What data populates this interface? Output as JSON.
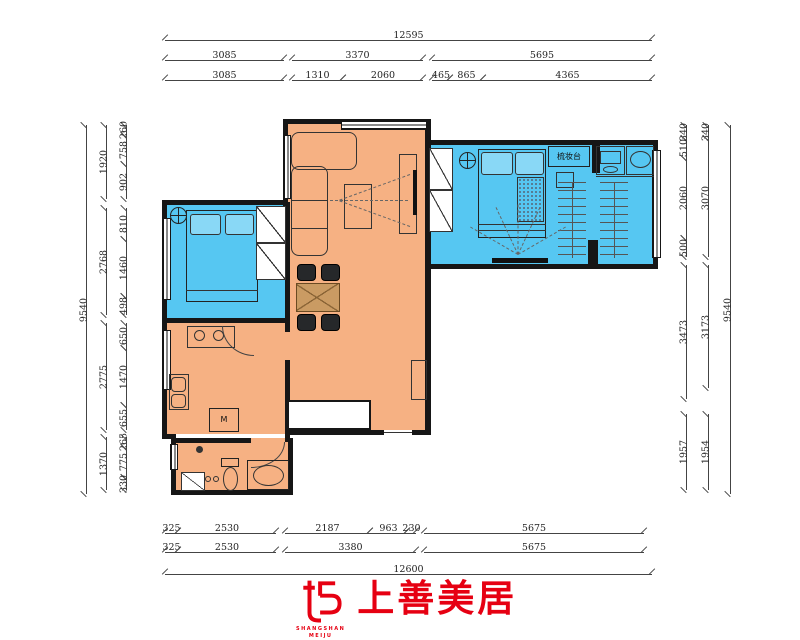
{
  "colors": {
    "orange": "#F6B183",
    "blue": "#56C7F2",
    "wall": "#161616",
    "dim": "#444",
    "red": "#E60012"
  },
  "logo": {
    "cn": "上善美居",
    "en1": "SHANGSHAN",
    "en2": "MEIJU"
  },
  "dims": {
    "h": [
      [
        "12595",
        165,
        40,
        487
      ],
      [
        "3085",
        165,
        60,
        119
      ],
      [
        "3370",
        292,
        60,
        131
      ],
      [
        "5695",
        432,
        60,
        220
      ],
      [
        "3085",
        165,
        80,
        119
      ],
      [
        "1310",
        292,
        80,
        51
      ],
      [
        "2060",
        343,
        80,
        80
      ],
      [
        "465",
        432,
        80,
        18
      ],
      [
        "865",
        450,
        80,
        33
      ],
      [
        "4365",
        483,
        80,
        169
      ],
      [
        "325",
        165,
        533,
        13
      ],
      [
        "2530",
        178,
        533,
        98
      ],
      [
        "2187",
        285,
        533,
        85
      ],
      [
        "963",
        370,
        533,
        37
      ],
      [
        "230",
        407,
        533,
        9
      ],
      [
        "5675",
        424,
        533,
        220
      ],
      [
        "325",
        165,
        552,
        13
      ],
      [
        "2530",
        178,
        552,
        98
      ],
      [
        "3380",
        285,
        552,
        131
      ],
      [
        "5675",
        424,
        552,
        220
      ],
      [
        "12600",
        165,
        574,
        487
      ]
    ],
    "v": [
      [
        "9540",
        86,
        125,
        369
      ],
      [
        "1920",
        106,
        125,
        74
      ],
      [
        "2768",
        106,
        208,
        107
      ],
      [
        "2775",
        106,
        323,
        107
      ],
      [
        "1370",
        106,
        437,
        53
      ],
      [
        "260",
        126,
        125,
        10
      ],
      [
        "758",
        126,
        135,
        29
      ],
      [
        "902",
        126,
        164,
        35
      ],
      [
        "810",
        126,
        208,
        31
      ],
      [
        "1460",
        126,
        239,
        57
      ],
      [
        "498",
        126,
        296,
        19
      ],
      [
        "650",
        126,
        323,
        25
      ],
      [
        "1470",
        126,
        348,
        57
      ],
      [
        "655",
        126,
        405,
        25
      ],
      [
        "265",
        126,
        437,
        10
      ],
      [
        "775",
        126,
        447,
        30
      ],
      [
        "330",
        126,
        477,
        13
      ],
      [
        "340",
        686,
        125,
        13
      ],
      [
        "510",
        686,
        138,
        20
      ],
      [
        "2060",
        686,
        158,
        80
      ],
      [
        "500",
        686,
        238,
        19
      ],
      [
        "3473",
        686,
        265,
        134
      ],
      [
        "1957",
        686,
        414,
        76
      ],
      [
        "340",
        708,
        125,
        13
      ],
      [
        "3070",
        708,
        138,
        119
      ],
      [
        "3173",
        708,
        265,
        123
      ],
      [
        "1954",
        708,
        414,
        76
      ],
      [
        "9540",
        730,
        125,
        369
      ]
    ]
  },
  "plan": {
    "items": [
      {
        "c": "room-orange",
        "n": "living-dining-area",
        "x": 287,
        "y": 123,
        "w": 140,
        "h": 307
      },
      {
        "c": "room-orange",
        "n": "kitchen-area",
        "x": 167,
        "y": 322,
        "w": 120,
        "h": 112
      },
      {
        "c": "room-orange",
        "n": "bathroom-area",
        "x": 175,
        "y": 438,
        "w": 116,
        "h": 54
      },
      {
        "c": "room-blue",
        "n": "bedroom-left-area",
        "x": 167,
        "y": 204,
        "w": 120,
        "h": 114
      },
      {
        "c": "room-blue",
        "n": "bedroom-right-area",
        "x": 427,
        "y": 144,
        "w": 228,
        "h": 120
      },
      {
        "c": "wall",
        "n": "wall",
        "x": 283,
        "y": 119,
        "w": 148,
        "h": 5
      },
      {
        "c": "wall",
        "n": "wall",
        "x": 283,
        "y": 119,
        "w": 5,
        "h": 88
      },
      {
        "c": "wall",
        "n": "wall",
        "x": 162,
        "y": 200,
        "w": 126,
        "h": 5
      },
      {
        "c": "wall",
        "n": "wall",
        "x": 162,
        "y": 200,
        "w": 5,
        "h": 122
      },
      {
        "c": "wall",
        "n": "wall",
        "x": 162,
        "y": 318,
        "w": 126,
        "h": 5
      },
      {
        "c": "wall",
        "n": "wall",
        "x": 162,
        "y": 318,
        "w": 5,
        "h": 120
      },
      {
        "c": "wall",
        "n": "wall",
        "x": 162,
        "y": 434,
        "w": 14,
        "h": 5
      },
      {
        "c": "wall",
        "n": "wall",
        "x": 171,
        "y": 438,
        "w": 5,
        "h": 57
      },
      {
        "c": "wall",
        "n": "wall",
        "x": 173,
        "y": 490,
        "w": 120,
        "h": 5
      },
      {
        "c": "wall",
        "n": "wall",
        "x": 288,
        "y": 438,
        "w": 5,
        "h": 57
      },
      {
        "c": "wall",
        "n": "wall",
        "x": 173,
        "y": 438,
        "w": 78,
        "h": 5
      },
      {
        "c": "wall",
        "n": "wall",
        "x": 285,
        "y": 202,
        "w": 5,
        "h": 130
      },
      {
        "c": "wall",
        "n": "wall",
        "x": 285,
        "y": 360,
        "w": 5,
        "h": 82
      },
      {
        "c": "wall",
        "n": "wall",
        "x": 285,
        "y": 430,
        "w": 99,
        "h": 5
      },
      {
        "c": "wall",
        "n": "wall",
        "x": 412,
        "y": 430,
        "w": 19,
        "h": 5
      },
      {
        "c": "wall",
        "n": "wall",
        "x": 425,
        "y": 119,
        "w": 6,
        "h": 28
      },
      {
        "c": "wall",
        "n": "wall",
        "x": 425,
        "y": 144,
        "w": 6,
        "h": 124
      },
      {
        "c": "wall",
        "n": "wall",
        "x": 425,
        "y": 266,
        "w": 6,
        "h": 169
      },
      {
        "c": "wall",
        "n": "wall",
        "x": 425,
        "y": 140,
        "w": 233,
        "h": 5
      },
      {
        "c": "wall",
        "n": "wall",
        "x": 653,
        "y": 140,
        "w": 5,
        "h": 129
      },
      {
        "c": "wall",
        "n": "wall",
        "x": 425,
        "y": 264,
        "w": 233,
        "h": 5
      },
      {
        "c": "wall",
        "n": "closet-partition",
        "x": 592,
        "y": 140,
        "w": 8,
        "h": 33
      },
      {
        "c": "wall",
        "n": "closet-partition",
        "x": 588,
        "y": 240,
        "w": 10,
        "h": 28
      },
      {
        "c": "winh",
        "n": "window",
        "x": 341,
        "y": 120,
        "w": 86,
        "h": 10
      },
      {
        "c": "winv",
        "n": "window",
        "x": 283,
        "y": 135,
        "w": 8,
        "h": 64
      },
      {
        "c": "winv",
        "n": "window",
        "x": 162,
        "y": 218,
        "w": 9,
        "h": 82
      },
      {
        "c": "winv",
        "n": "window",
        "x": 162,
        "y": 330,
        "w": 9,
        "h": 60
      },
      {
        "c": "winv",
        "n": "window",
        "x": 170,
        "y": 444,
        "w": 8,
        "h": 26
      },
      {
        "c": "winv",
        "n": "window",
        "x": 652,
        "y": 150,
        "w": 9,
        "h": 108
      },
      {
        "c": "light",
        "n": "ceiling-light-icon",
        "x": 170,
        "y": 207,
        "w": 17,
        "h": 17
      },
      {
        "c": "f2",
        "n": "bed-left",
        "x": 186,
        "y": 210,
        "w": 72,
        "h": 92
      },
      {
        "c": "pillow",
        "n": "pillow",
        "x": 190,
        "y": 214,
        "w": 31,
        "h": 21
      },
      {
        "c": "pillow",
        "n": "pillow",
        "x": 225,
        "y": 214,
        "w": 29,
        "h": 21
      },
      {
        "c": "ln",
        "n": "bed-line",
        "x": 186,
        "y": 290,
        "w": 72,
        "h": 1
      },
      {
        "c": "diag",
        "n": "wardrobe",
        "x": 256,
        "y": 206,
        "w": 30,
        "h": 37
      },
      {
        "c": "diag",
        "n": "wardrobe",
        "x": 256,
        "y": 243,
        "w": 30,
        "h": 37
      },
      {
        "c": "f",
        "n": "sofa",
        "x": 291,
        "y": 132,
        "w": 66,
        "h": 38,
        "br": "8px"
      },
      {
        "c": "f",
        "n": "sofa-chaise",
        "x": 291,
        "y": 166,
        "w": 37,
        "h": 90,
        "br": "8px"
      },
      {
        "c": "ln",
        "n": "sofa-line",
        "x": 291,
        "y": 200,
        "w": 37,
        "h": 1
      },
      {
        "c": "ln",
        "n": "sofa-line",
        "x": 291,
        "y": 228,
        "w": 37,
        "h": 1
      },
      {
        "c": "f",
        "n": "coffee-table",
        "x": 344,
        "y": 184,
        "w": 28,
        "h": 45
      },
      {
        "c": "f",
        "n": "tv-cabinet",
        "x": 399,
        "y": 154,
        "w": 18,
        "h": 80
      },
      {
        "c": "dash",
        "n": "tv-projection",
        "x": 410,
        "y": 174,
        "w": 75,
        "r": 160
      },
      {
        "c": "dash",
        "n": "tv-projection",
        "x": 408,
        "y": 200,
        "w": 78,
        "r": 180
      },
      {
        "c": "dash",
        "n": "tv-projection",
        "x": 410,
        "y": 226,
        "w": 75,
        "r": -160
      },
      {
        "c": "tv",
        "n": "tv",
        "x": 413,
        "y": 170,
        "w": 4,
        "h": 45
      },
      {
        "c": "chair",
        "n": "dining-chair",
        "x": 297,
        "y": 264,
        "w": 19,
        "h": 17
      },
      {
        "c": "chair",
        "n": "dining-chair",
        "x": 321,
        "y": 264,
        "w": 19,
        "h": 17
      },
      {
        "c": "chair",
        "n": "dining-chair",
        "x": 297,
        "y": 314,
        "w": 19,
        "h": 17
      },
      {
        "c": "chair",
        "n": "dining-chair",
        "x": 321,
        "y": 314,
        "w": 19,
        "h": 17
      },
      {
        "c": "tan",
        "n": "dining-table",
        "x": 296,
        "y": 283,
        "w": 44,
        "h": 29
      },
      {
        "c": "f",
        "n": "shoe-cabinet",
        "x": 411,
        "y": 360,
        "w": 16,
        "h": 40
      },
      {
        "c": "whitebox",
        "n": "shaft",
        "x": 287,
        "y": 400,
        "w": 84,
        "h": 30
      },
      {
        "c": "ln",
        "n": "entry-threshold",
        "x": 384,
        "y": 432,
        "w": 28,
        "h": 1
      },
      {
        "c": "f",
        "n": "stove-counter",
        "x": 187,
        "y": 326,
        "w": 48,
        "h": 22
      },
      {
        "c": "oval",
        "n": "burner",
        "x": 194,
        "y": 330,
        "w": 11,
        "h": 11
      },
      {
        "c": "oval",
        "n": "burner",
        "x": 213,
        "y": 330,
        "w": 11,
        "h": 11
      },
      {
        "c": "arcbl",
        "n": "door-arc",
        "x": 222,
        "y": 326,
        "w": 32,
        "h": 30
      },
      {
        "c": "f",
        "n": "kitchen-sink",
        "x": 169,
        "y": 374,
        "w": 20,
        "h": 36
      },
      {
        "c": "f",
        "n": "sink-basin",
        "x": 171,
        "y": 377,
        "w": 15,
        "h": 15,
        "br": "4px"
      },
      {
        "c": "f",
        "n": "sink-basin",
        "x": 171,
        "y": 394,
        "w": 15,
        "h": 14,
        "br": "4px"
      },
      {
        "c": "labelbox",
        "n": "washing-machine",
        "x": 209,
        "y": 408,
        "w": 30,
        "h": 24,
        "t": "M"
      },
      {
        "c": "arcbr",
        "n": "door-arc",
        "x": 251,
        "y": 442,
        "w": 34,
        "h": 26
      },
      {
        "c": "dot",
        "n": "floor-drain",
        "x": 196,
        "y": 446,
        "w": 7,
        "h": 7
      },
      {
        "c": "f2",
        "n": "toilet-tank",
        "x": 221,
        "y": 458,
        "w": 18,
        "h": 9
      },
      {
        "c": "oval",
        "n": "toilet",
        "x": 223,
        "y": 467,
        "w": 15,
        "h": 24
      },
      {
        "c": "oval",
        "n": "drain",
        "x": 205,
        "y": 476,
        "w": 6,
        "h": 6
      },
      {
        "c": "oval",
        "n": "drain",
        "x": 213,
        "y": 476,
        "w": 6,
        "h": 6
      },
      {
        "c": "f2",
        "n": "vanity",
        "x": 247,
        "y": 460,
        "w": 42,
        "h": 30
      },
      {
        "c": "oval",
        "n": "wash-basin",
        "x": 253,
        "y": 465,
        "w": 31,
        "h": 21
      },
      {
        "c": "diag",
        "n": "bath-door",
        "x": 181,
        "y": 472,
        "w": 24,
        "h": 19
      },
      {
        "c": "diag",
        "n": "wardrobe",
        "x": 429,
        "y": 148,
        "w": 24,
        "h": 42
      },
      {
        "c": "diag",
        "n": "wardrobe",
        "x": 429,
        "y": 190,
        "w": 24,
        "h": 42
      },
      {
        "c": "light",
        "n": "ceiling-light-icon",
        "x": 459,
        "y": 152,
        "w": 17,
        "h": 17
      },
      {
        "c": "f2",
        "n": "bed-right",
        "x": 478,
        "y": 149,
        "w": 68,
        "h": 89
      },
      {
        "c": "pillow",
        "n": "pillow",
        "x": 481,
        "y": 152,
        "w": 32,
        "h": 23
      },
      {
        "c": "pillow",
        "n": "pillow",
        "x": 515,
        "y": 152,
        "w": 29,
        "h": 23
      },
      {
        "c": "dots",
        "n": "blanket",
        "x": 517,
        "y": 177,
        "w": 27,
        "h": 45
      },
      {
        "c": "ln",
        "n": "bed-line",
        "x": 478,
        "y": 224,
        "w": 68,
        "h": 1
      },
      {
        "c": "ln",
        "n": "bed-line",
        "x": 478,
        "y": 230,
        "w": 68,
        "h": 1
      },
      {
        "c": "labelbox",
        "n": "dressing-table",
        "x": 548,
        "y": 146,
        "w": 42,
        "h": 21,
        "t": "梳妆台"
      },
      {
        "c": "f",
        "n": "stool",
        "x": 556,
        "y": 172,
        "w": 18,
        "h": 16
      },
      {
        "c": "f",
        "n": "washing-machine",
        "x": 596,
        "y": 146,
        "w": 29,
        "h": 29
      },
      {
        "c": "f",
        "n": "washer-drum",
        "x": 600,
        "y": 151,
        "w": 21,
        "h": 13
      },
      {
        "c": "oval",
        "n": "washer-door",
        "x": 603,
        "y": 166,
        "w": 15,
        "h": 7
      },
      {
        "c": "f",
        "n": "basin-counter",
        "x": 626,
        "y": 146,
        "w": 28,
        "h": 29
      },
      {
        "c": "oval",
        "n": "wash-basin",
        "x": 630,
        "y": 151,
        "w": 21,
        "h": 17
      },
      {
        "c": "ln",
        "n": "counter-line",
        "x": 596,
        "y": 176,
        "w": 58,
        "h": 1
      },
      {
        "c": "hang",
        "n": "clothes-rail",
        "x": 558,
        "y": 182,
        "w": 28,
        "h": 76
      },
      {
        "c": "hang",
        "n": "clothes-rail",
        "x": 600,
        "y": 182,
        "w": 28,
        "h": 76
      },
      {
        "c": "dash",
        "n": "tv-projection",
        "x": 518,
        "y": 254,
        "w": 55,
        "r": -150
      },
      {
        "c": "dash",
        "n": "tv-projection",
        "x": 518,
        "y": 254,
        "w": 52,
        "r": -115
      },
      {
        "c": "dash",
        "n": "tv-projection",
        "x": 518,
        "y": 254,
        "w": 50,
        "r": -90
      },
      {
        "c": "dash",
        "n": "tv-projection",
        "x": 518,
        "y": 254,
        "w": 52,
        "r": -65
      },
      {
        "c": "dash",
        "n": "tv-projection",
        "x": 518,
        "y": 254,
        "w": 55,
        "r": -30
      },
      {
        "c": "tv",
        "n": "tv",
        "x": 492,
        "y": 258,
        "w": 56,
        "h": 5
      }
    ]
  }
}
